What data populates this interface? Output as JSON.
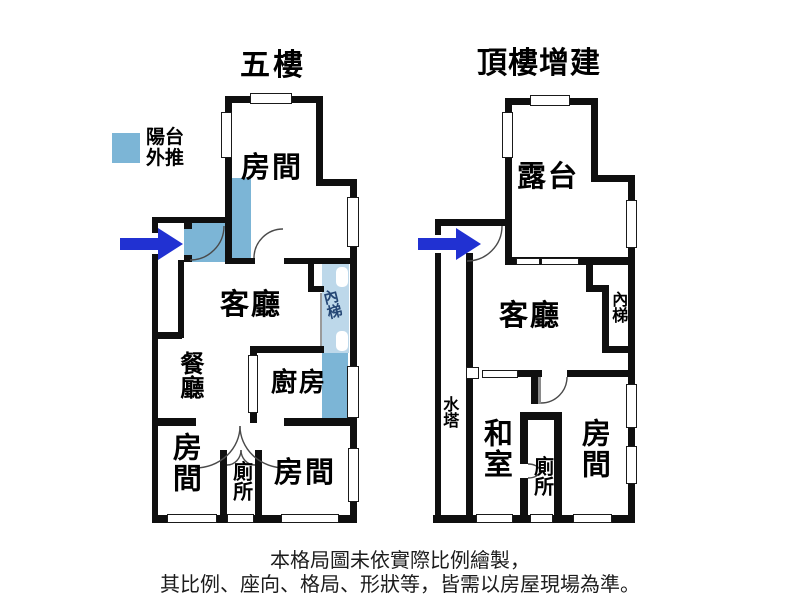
{
  "colors": {
    "arrow": "#2131d2",
    "balcony": "#7cb5d6",
    "balconyLight": "#bdd8ea",
    "wall": "#0f0f0f",
    "navy": "#1c3f6e"
  },
  "legend": {
    "line1": "陽台",
    "line2": "外推"
  },
  "plan_left": {
    "title": "五樓",
    "bedroom_top": "房間",
    "living": "客廳",
    "dining": "餐廳",
    "kitchen": "廚房",
    "stairs": "內梯",
    "bedroom_bottom_left": "房間",
    "toilet": "廁所",
    "bedroom_bottom_right": "房間"
  },
  "plan_right": {
    "title": "頂樓增建",
    "terrace": "露台",
    "living": "客廳",
    "stairs": "內梯",
    "water_tank": "水塔",
    "tatami_room": "和室",
    "toilet": "廁所",
    "bedroom": "房間"
  },
  "footer": {
    "line1": "本格局圖未依實際比例繪製，",
    "line2": "其比例、座向、格局、形狀等，皆需以房屋現場為準。"
  }
}
